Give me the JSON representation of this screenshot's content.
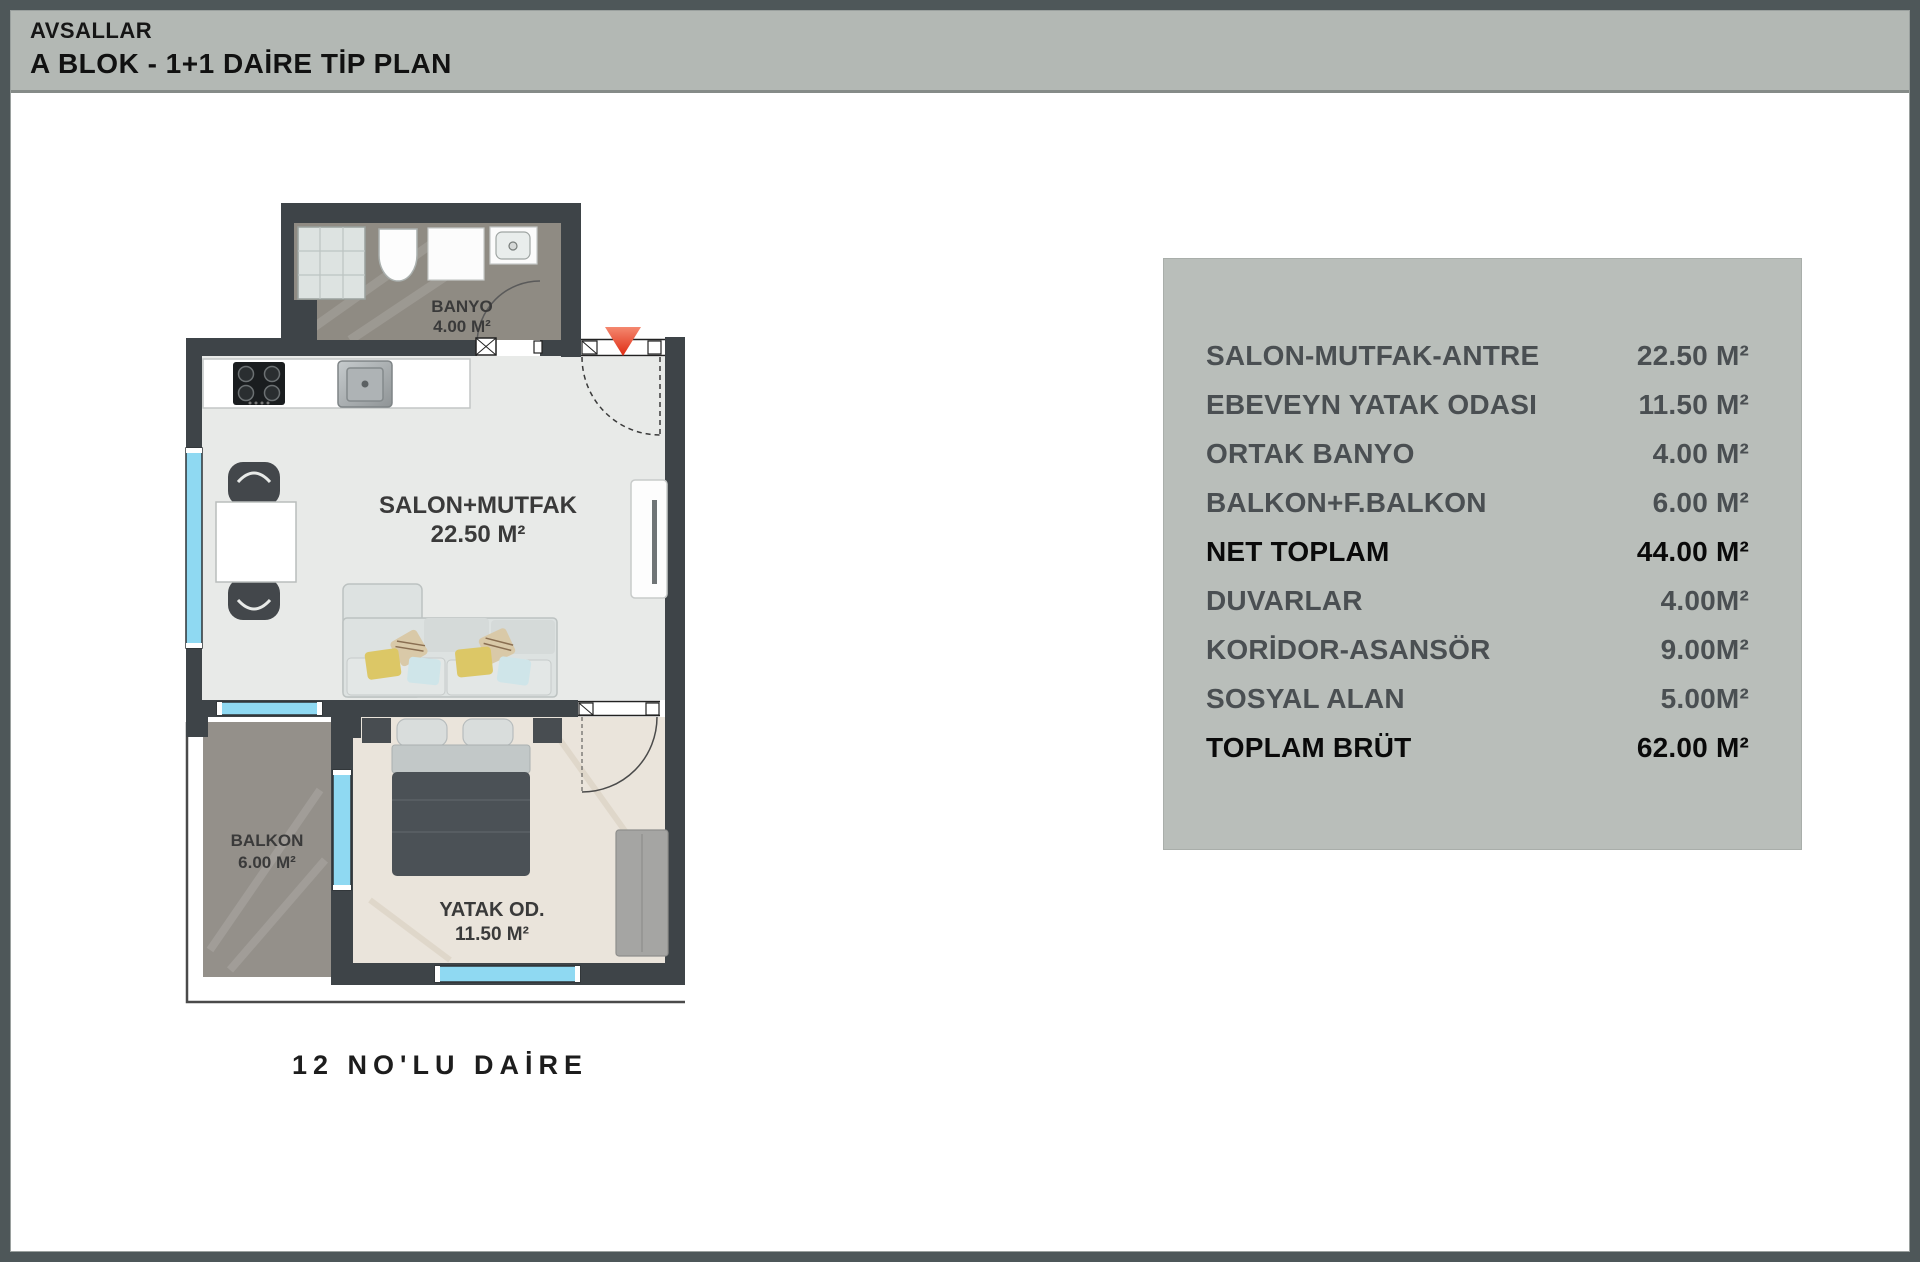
{
  "header": {
    "project": "AVSALLAR",
    "title": "A BLOK  -  1+1 DAİRE TİP PLAN"
  },
  "plan": {
    "unit_label": "12 NO'LU DAİRE",
    "rooms": {
      "banyo": {
        "name": "BANYO",
        "area": "4.00 M²"
      },
      "salon": {
        "name": "SALON+MUTFAK",
        "area": "22.50 M²"
      },
      "balkon": {
        "name": "BALKON",
        "area": "6.00 M²"
      },
      "yatak": {
        "name": "YATAK OD.",
        "area": "11.50 M²"
      }
    },
    "icons": {
      "entrance_arrow": "entrance-arrow-down"
    }
  },
  "table": {
    "rows": [
      {
        "label": "SALON-MUTFAK-ANTRE",
        "value": "22.50 M²"
      },
      {
        "label": "EBEVEYN YATAK ODASI",
        "value": "11.50 M²"
      },
      {
        "label": "ORTAK BANYO",
        "value": "4.00 M²"
      },
      {
        "label": "BALKON+F.BALKON",
        "value": "6.00 M²"
      },
      {
        "label": "NET TOPLAM",
        "value": "44.00 M²"
      },
      {
        "label": "DUVARLAR",
        "value": "4.00M²"
      },
      {
        "label": "KORİDOR-ASANSÖR",
        "value": "9.00M²"
      },
      {
        "label": "SOSYAL ALAN",
        "value": "5.00M²"
      },
      {
        "label": "TOPLAM BRÜT",
        "value": "62.00 M²"
      }
    ]
  },
  "colors": {
    "wall": "#3e4448",
    "window_blue": "#8fd9f2",
    "entrance_red": "#e23018",
    "panel_bg": "#b9beba",
    "header_bg": "#b3b8b4",
    "bath_floor": "#8f8b83",
    "balcony_floor": "#94908a",
    "salon_floor": "#e8eae8",
    "bedroom_floor": "#eae4db"
  }
}
